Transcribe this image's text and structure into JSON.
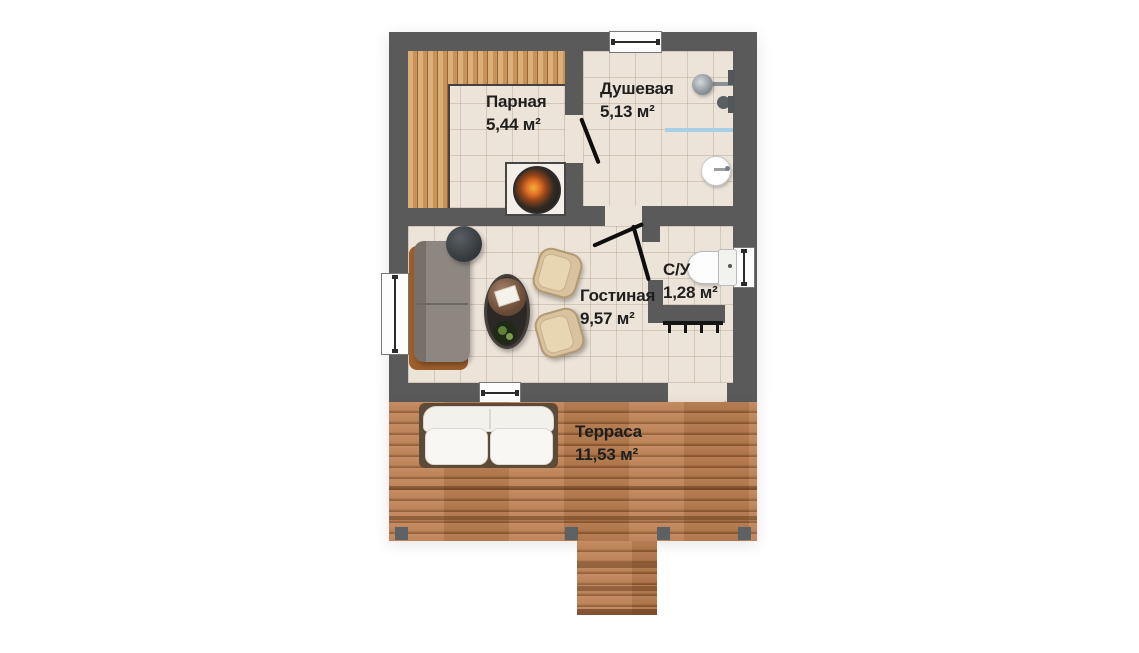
{
  "plan": {
    "type": "floor-plan",
    "rooms": [
      {
        "name": "Парная",
        "area": "5,44 м²"
      },
      {
        "name": "Душевая",
        "area": "5,13 м²"
      },
      {
        "name": "Гостиная",
        "area": "9,57 м²"
      },
      {
        "name": "С/У",
        "area": "1,28 м²"
      },
      {
        "name": "Терраса",
        "area": "11,53 м²"
      }
    ],
    "colors": {
      "wall": "#5a5a5a",
      "floor_tile": "#ece3d9",
      "bench_wood": "#c79359",
      "deck_wood": "#b87c4e",
      "shower_glass": "#a9cfe6",
      "door_line": "#0e0e0e",
      "label_text": "#1f1f1f"
    },
    "icons": {
      "stove-icon": "dark circle with fire glow on white hearth",
      "shower-head-icon": "gray circle with wall arm",
      "shower-glass-icon": "light-blue line",
      "sink-icon": "white circle with faucet",
      "toilet-icon": "white bowl with tank",
      "radiator-icon": "black line with ticks",
      "sofa-icon": "gray sofa on wood frame",
      "side-table-icon": "dark circle",
      "coffee-table-icon": "dark oval with marble top and plant",
      "armchair-icon": "beige rounded chair",
      "terrace-sofa-icon": "white two-seat sofa",
      "window-icon": "white rect with frame line",
      "door-swing-icon": "black diagonal leaf",
      "deck-post-icon": "gray square",
      "steps-icon": "plank steps"
    }
  }
}
